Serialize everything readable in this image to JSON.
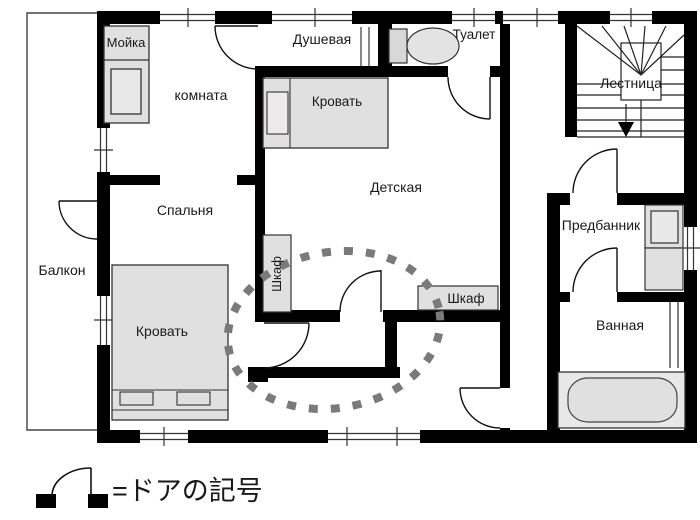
{
  "rooms": {
    "moyka": "Мойка",
    "komnata": "комната",
    "dushevaya": "Душевая",
    "tualet": "Туалет",
    "lestnitsa": "Лестница",
    "detskaya": "Детская",
    "spalnya": "Спальня",
    "balkon": "Балкон",
    "predbannik": "Предбанник",
    "vannaya": "Ванная"
  },
  "furniture": {
    "bed_detskaya": "Кровать",
    "bed_spalnya": "Кровать",
    "wardrobe_vertical": "Шкаф",
    "wardrobe_horizontal": "Шкаф"
  },
  "legend": {
    "door_label": "=ドアの記号"
  },
  "colors": {
    "wall": "#000000",
    "furniture_fill": "#e0e0e0",
    "highlight": "#7a7a7a",
    "background": "#ffffff"
  }
}
